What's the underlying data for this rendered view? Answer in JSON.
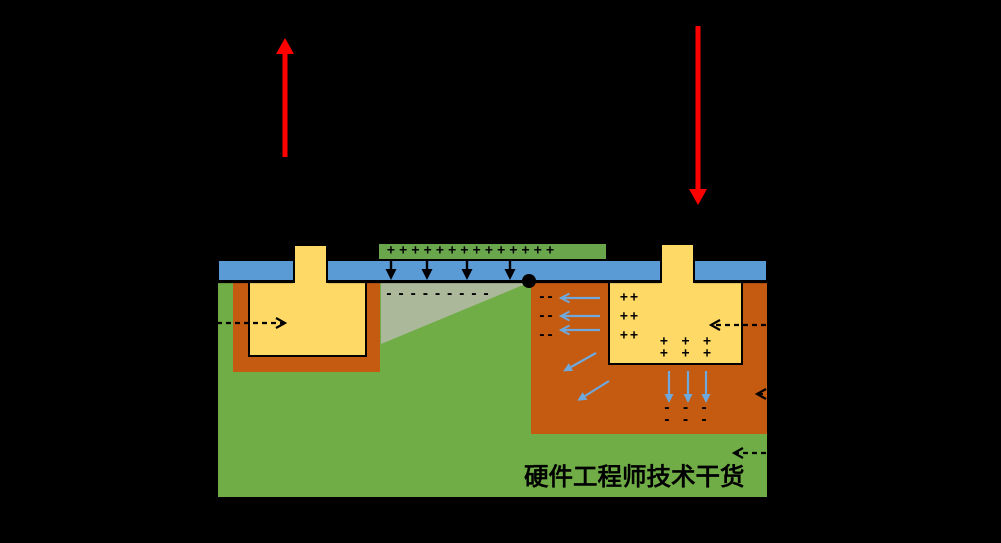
{
  "watermark": {
    "text": "硬件工程师技术干货"
  },
  "charges": {
    "gate_plus_row": "+ + + + + + + + + + + + + +",
    "surface_minus_row": "- - - - - - - - -",
    "nwell_minus_pairs": [
      "- -",
      "- -",
      "- -"
    ],
    "diffusion_plus_pairs": [
      "+ +",
      "+ +",
      "+ +"
    ],
    "diffusion_bottom_plus_rows": [
      "+ + +",
      "+ + +"
    ],
    "well_bottom_minus_rows": [
      "- - -",
      "- - -"
    ]
  },
  "colors": {
    "background": "#000000",
    "substrate_green": "#70AD47",
    "gate_green": "#69A64C",
    "oxide_blue": "#5B9BD5",
    "well_orange": "#C55A11",
    "diffusion_yellow": "#FFD966",
    "depletion_gray": "#ACB89A",
    "arrow_blue": "#6FA8DC",
    "arrow_red": "#FF0000",
    "ink_black": "#000000"
  }
}
